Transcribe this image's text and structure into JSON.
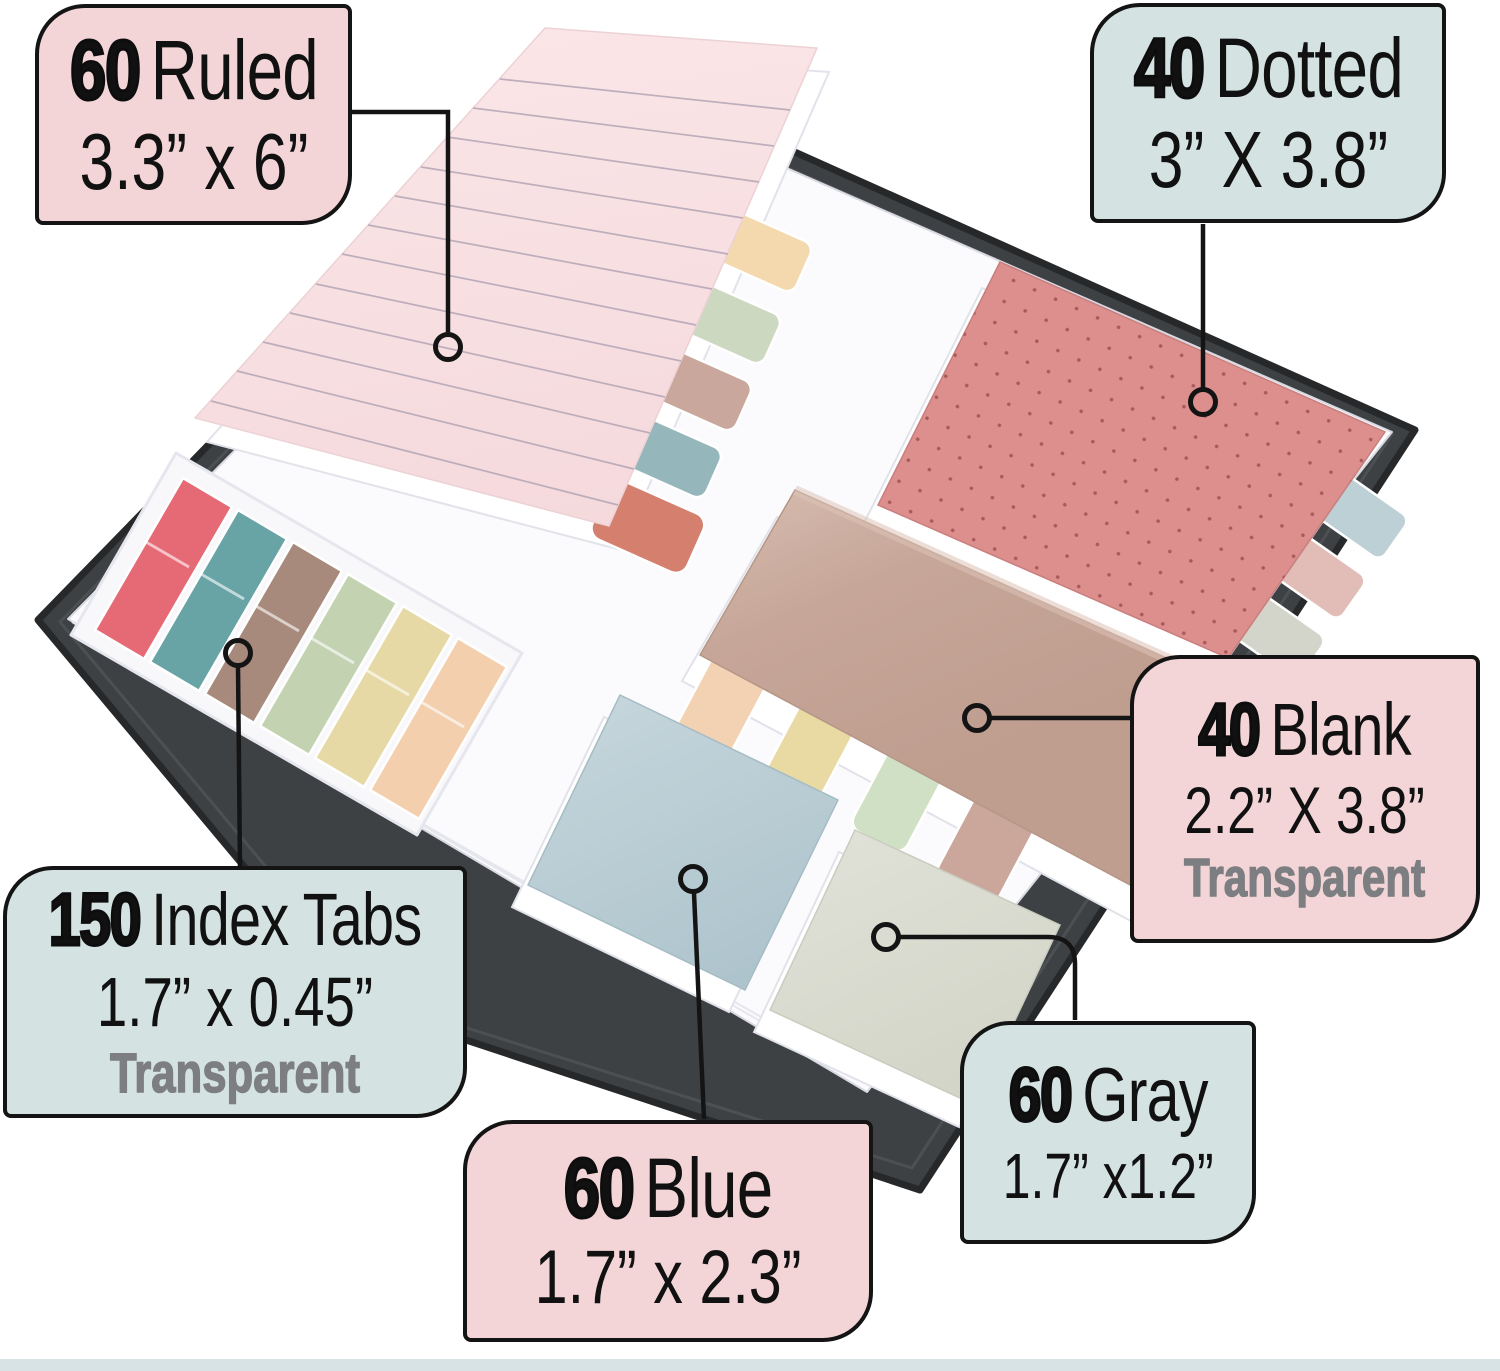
{
  "callouts": {
    "ruled": {
      "count": "60",
      "label": "Ruled",
      "dimensions": "3.3” x 6”"
    },
    "dotted": {
      "count": "40",
      "label": "Dotted",
      "dimensions": "3” X 3.8”"
    },
    "blank": {
      "count": "40",
      "label": "Blank",
      "dimensions": "2.2” X 3.8”",
      "note": "Transparent"
    },
    "index_tabs": {
      "count": "150",
      "label": "Index Tabs",
      "dimensions": "1.7” x 0.45”",
      "note": "Transparent"
    },
    "blue": {
      "count": "60",
      "label": "Blue",
      "dimensions": "1.7” x 2.3”"
    },
    "gray": {
      "count": "60",
      "label": "Gray",
      "dimensions": "1.7” x1.2”"
    }
  },
  "colors": {
    "callout_pink": "#f3d5d8",
    "callout_teal": "#d4e2e1",
    "outline": "#141414",
    "transparent_note": "#7c7e81",
    "folder": "#3e4143",
    "folder_edge": "#26282a",
    "pages": "#fbfbfd",
    "tray": "#f8f8fb",
    "ruled_pad": "#f8e0e2",
    "ruled_line": "#b3a5b5",
    "dotted_pad": "#dc8f8c",
    "dotted_dot": "#a85959",
    "blank_pad": "#c2a294",
    "blank_pad_light": "#d0b5a8",
    "blue_pad": "#b5cad2",
    "gray_pad": "#d9dbd0",
    "bottom_band": "#d8e3e5"
  },
  "index_tab_strips": [
    {
      "name": "red",
      "color": "#e56a76"
    },
    {
      "name": "teal",
      "color": "#68a4a6"
    },
    {
      "name": "brown",
      "color": "#a88a7d"
    },
    {
      "name": "green",
      "color": "#c3d3b2"
    },
    {
      "name": "yellow",
      "color": "#e7d9a5"
    },
    {
      "name": "peach",
      "color": "#f3cfad"
    }
  ],
  "ruled_pad_tabs": [
    {
      "name": "peach",
      "color": "#f4d8ae"
    },
    {
      "name": "green",
      "color": "#cdd8c1"
    },
    {
      "name": "mauve",
      "color": "#c9a79c"
    },
    {
      "name": "teal",
      "color": "#95b6bb"
    },
    {
      "name": "salmon",
      "color": "#d5806f"
    }
  ],
  "dotted_pad_tabs": [
    {
      "name": "blue",
      "color": "#bdd0d6"
    },
    {
      "name": "pink",
      "color": "#e2bcb6"
    },
    {
      "name": "gray",
      "color": "#d3d5cb"
    }
  ],
  "blank_pad_tabs": [
    {
      "name": "peach",
      "color": "#f3d2b4"
    },
    {
      "name": "yellow",
      "color": "#e9d9a3"
    },
    {
      "name": "green",
      "color": "#cfe0c5"
    },
    {
      "name": "mauve",
      "color": "#cba69b"
    }
  ]
}
